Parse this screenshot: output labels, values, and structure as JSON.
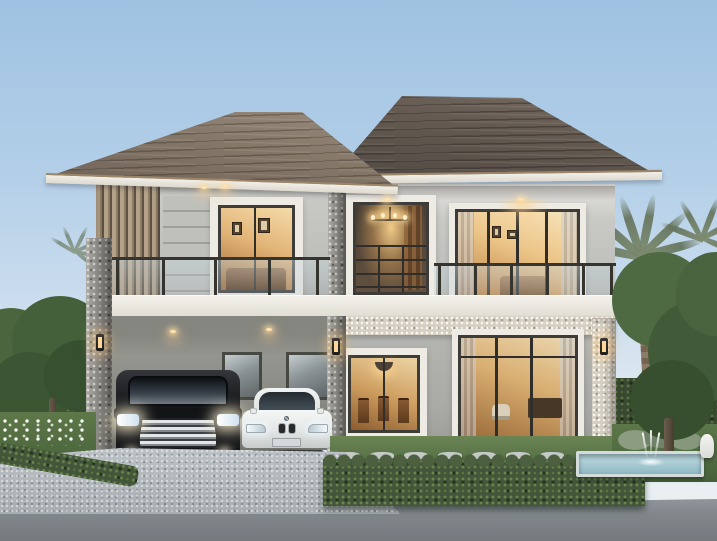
{
  "scene": {
    "type": "exterior-architectural-rendering",
    "time_of_day": "dusk",
    "description": "Modern two-storey detached house with brown hip roof, glass balconies and warmly lit interiors; double carport sheltering a black luxury minivan and a white sedan; cobblestone driveway, trimmed hedges, lawn with stepping stones, palm and broadleaf trees, and a small fountain pool at right.",
    "house": {
      "storeys": 2,
      "roof": "hip roof, two overlapping masses, grey-brown tiles with cream fascia",
      "upper_floor": [
        "timber slat screen",
        "horizontal siding panel",
        "bedroom window with picture frames",
        "stairwell window with chandelier",
        "master bedroom sliding doors",
        "two glass balustrade balconies"
      ],
      "ground_floor": [
        "double carport with two windows and ceiling downlights",
        "dining window with pendant light and wooden chairs",
        "living room sliding doors with furniture",
        "pebble-stone beam and corner columns",
        "three lit wall sconces"
      ],
      "vehicles": [
        "black luxury minivan with chrome grille and lit headlights",
        "white sedan with twin kidney grille"
      ]
    },
    "landscape": [
      "left garden tree with white flower bed",
      "low hedge along driveway",
      "front boxwood hedge row",
      "stepping stones on lawn",
      "reflecting pool with fountain jet and white statue",
      "palm trees and large green tree at right",
      "background hedges"
    ],
    "ground": [
      "cobblestone paver driveway",
      "asphalt road strip at bottom"
    ]
  },
  "palette": {
    "sky_top": "#9fc2e2",
    "sky_horizon": "#edf1f3",
    "roof_dark": "#564e46",
    "roof_light": "#8c7e70",
    "fascia_trim": "#f2efe8",
    "roof_edge_tan": "#9c8669",
    "wall_upper": "#c9cac6",
    "wall_lower": "#adaeaa",
    "stone_column": "#96948e",
    "pebble_band": "#d6d0c3",
    "window_frame": "#3e3c39",
    "warm_interior": "#e2b477",
    "warm_light_glow": "#ffd89a",
    "balcony_glass": "#b8ccd4",
    "minivan_black": "#121316",
    "sedan_white": "#eef0ef",
    "lawn_green": "#5e7849",
    "hedge_green": "#43563a",
    "pool_water": "#8db8c4",
    "paver_grey": "#b3b8bd",
    "road_grey": "#83888d"
  }
}
